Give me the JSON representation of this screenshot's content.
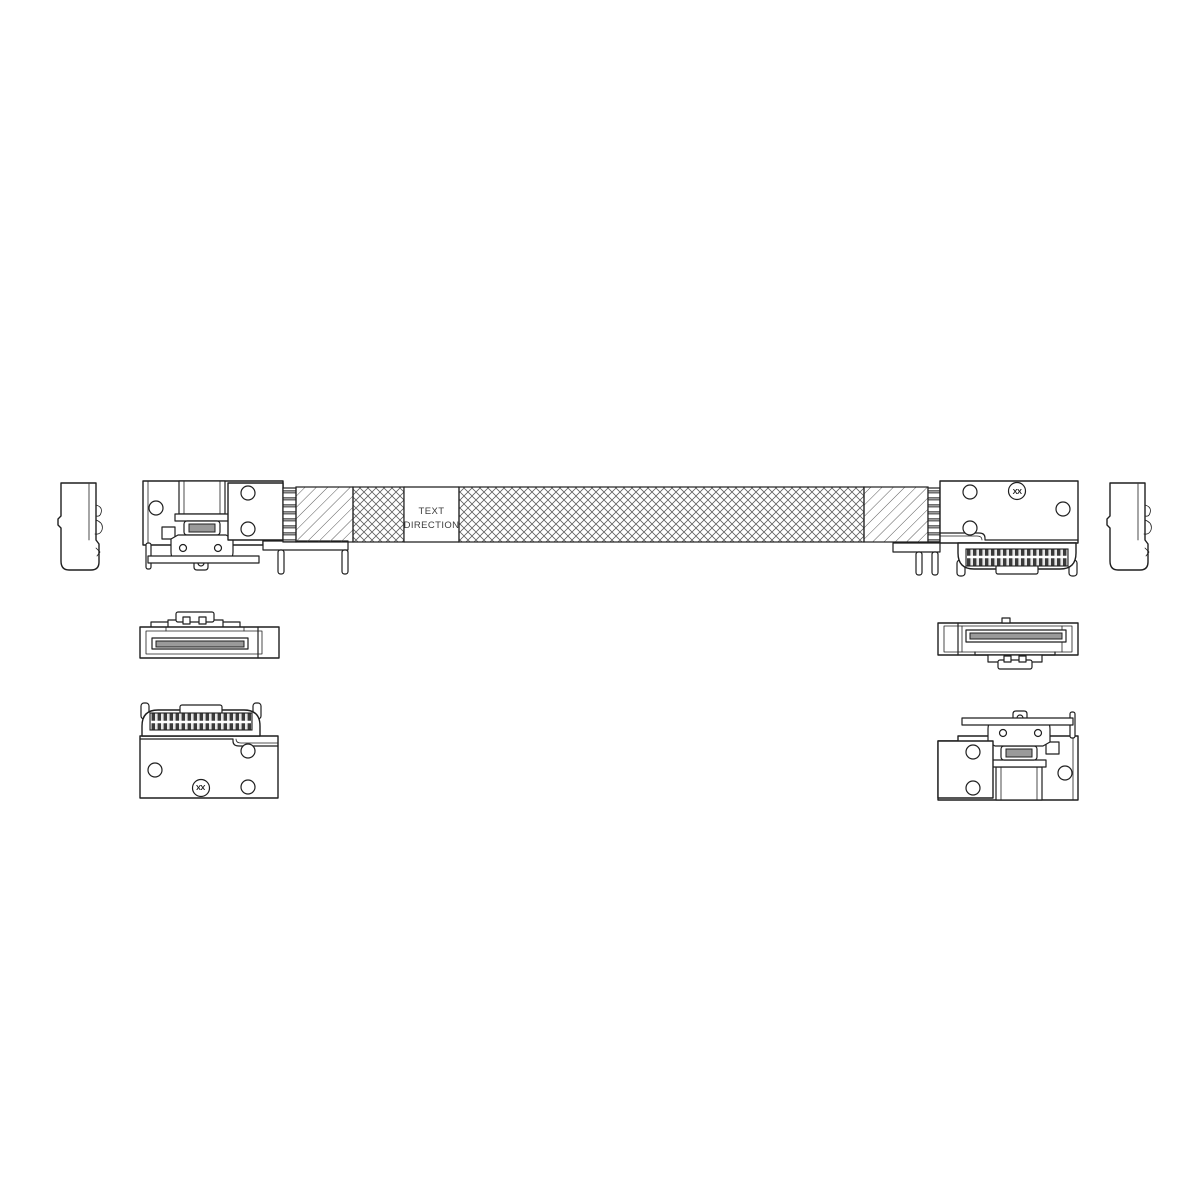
{
  "canvas": {
    "width": 1200,
    "height": 1200,
    "background": "#ffffff"
  },
  "style": {
    "line_color": "#1f1f1f",
    "hatch_color": "#5a5a5a",
    "crosshatch_color": "#606060",
    "slot_fill": "#9a9a9a",
    "ribbon_fill": "#9a9a9a",
    "teeth_dark": "#3a3a3a",
    "teeth_light": "#e6e6e6",
    "label_text_color": "#3c3c3c"
  },
  "cable_label": {
    "line1": "TEXT",
    "line2": "DIRECTION"
  },
  "datum_marks": {
    "right_connector_front": "XX",
    "left_connector_bottom": "XX"
  }
}
